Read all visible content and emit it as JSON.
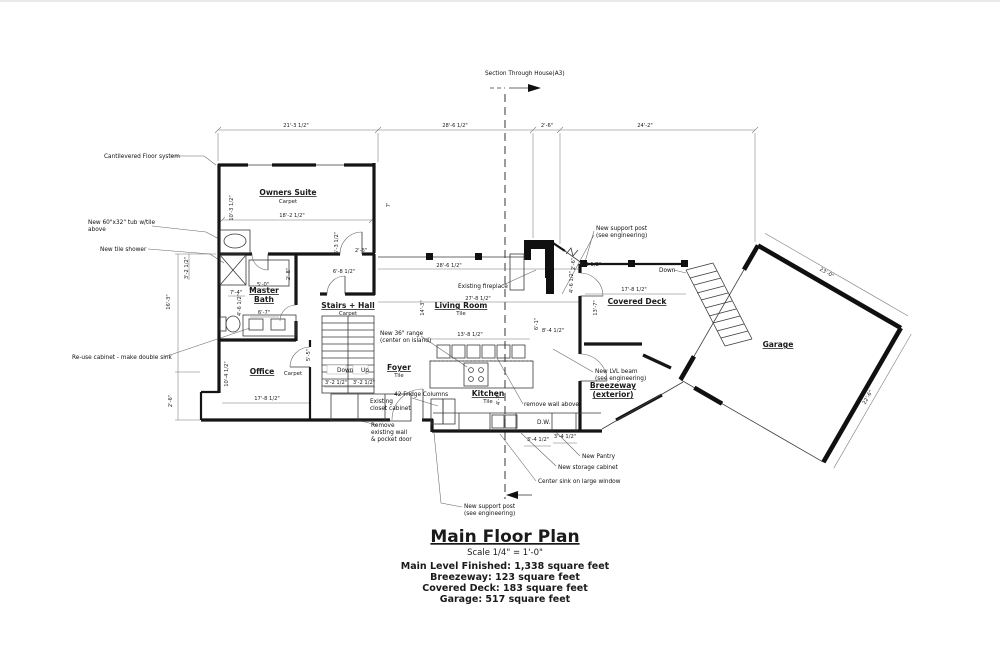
{
  "drawing": {
    "section_label": "Section Through House(A3)",
    "title": "Main Floor Plan",
    "scale": "Scale 1/4\" = 1'-0\"",
    "stats": [
      "Main Level Finished: 1,338 square feet",
      "Breezeway: 123 square feet",
      "Covered Deck: 183 square feet",
      "Garage: 517 square feet"
    ]
  },
  "rooms": [
    {
      "t": "Owners Suite",
      "x": 288,
      "y": 193
    },
    {
      "t": "Master",
      "x": 264,
      "y": 291
    },
    {
      "t": "Bath",
      "x": 264,
      "y": 300
    },
    {
      "t": "Office",
      "x": 262,
      "y": 372
    },
    {
      "t": "Stairs + Hall",
      "x": 348,
      "y": 306
    },
    {
      "t": "Foyer",
      "x": 399,
      "y": 368
    },
    {
      "t": "Living Room",
      "x": 461,
      "y": 306
    },
    {
      "t": "Kitchen",
      "x": 488,
      "y": 394
    },
    {
      "t": "Covered Deck",
      "x": 637,
      "y": 302
    },
    {
      "t": "Garage",
      "x": 778,
      "y": 345
    },
    {
      "t": "Breezeway",
      "x": 613,
      "y": 386
    },
    {
      "t": "(exterior)",
      "x": 613,
      "y": 395
    }
  ],
  "floor_finishes": [
    {
      "t": "Carpet",
      "x": 288,
      "y": 201
    },
    {
      "t": "Carpet",
      "x": 293,
      "y": 373
    },
    {
      "t": "Carpet",
      "x": 348,
      "y": 313
    },
    {
      "t": "Tile",
      "x": 399,
      "y": 375
    },
    {
      "t": "Tile",
      "x": 461,
      "y": 313
    },
    {
      "t": "Tile",
      "x": 488,
      "y": 401
    }
  ],
  "annotations": [
    {
      "t": "Section Through House(A3)",
      "x": 485,
      "y": 73
    },
    {
      "t": "Cantilevered Floor system",
      "x": 104,
      "y": 156
    },
    {
      "t": "New 60\"x32\" tub w/tile",
      "x": 88,
      "y": 222
    },
    {
      "t": "above",
      "x": 88,
      "y": 229
    },
    {
      "t": "New tile shower",
      "x": 100,
      "y": 249
    },
    {
      "t": "Re-use cabinet - make double sink",
      "x": 72,
      "y": 357
    },
    {
      "t": "Existing fireplace",
      "x": 458,
      "y": 286
    },
    {
      "t": "New support post",
      "x": 596,
      "y": 228
    },
    {
      "t": "(see engineering)",
      "x": 596,
      "y": 235
    },
    {
      "t": "Down",
      "x": 659,
      "y": 270
    },
    {
      "t": "New 36\" range",
      "x": 380,
      "y": 333
    },
    {
      "t": "(center on island)",
      "x": 380,
      "y": 340
    },
    {
      "t": "remove wall above",
      "x": 524,
      "y": 404
    },
    {
      "t": "New LVL beam",
      "x": 595,
      "y": 371
    },
    {
      "t": "(see engineering)",
      "x": 595,
      "y": 378
    },
    {
      "t": "New Pantry",
      "x": 582,
      "y": 456
    },
    {
      "t": "New storage cabinet",
      "x": 558,
      "y": 467
    },
    {
      "t": "Center sink on large window",
      "x": 538,
      "y": 481
    },
    {
      "t": "42 Fridge Columns",
      "x": 394,
      "y": 394
    },
    {
      "t": "Remove",
      "x": 371,
      "y": 425
    },
    {
      "t": "existing wall",
      "x": 371,
      "y": 432
    },
    {
      "t": "& pocket door",
      "x": 371,
      "y": 439
    },
    {
      "t": "New support post",
      "x": 464,
      "y": 506
    },
    {
      "t": "(see engineering)",
      "x": 464,
      "y": 513
    },
    {
      "t": "Existing",
      "x": 370,
      "y": 401,
      "a": "middle"
    },
    {
      "t": "closet cabinet",
      "x": 370,
      "y": 408,
      "a": "middle"
    },
    {
      "t": "Down",
      "x": 337,
      "y": 370,
      "a": "middle"
    },
    {
      "t": "Up",
      "x": 361,
      "y": 370,
      "a": "middle"
    },
    {
      "t": "D.W.",
      "x": 537,
      "y": 422,
      "a": "middle"
    }
  ],
  "dimensions": [
    {
      "t": "21'-3 1/2\"",
      "x": 296,
      "y": 125
    },
    {
      "t": "28'-6 1/2\"",
      "x": 455,
      "y": 125
    },
    {
      "t": "2'-6\"",
      "x": 547,
      "y": 125
    },
    {
      "t": "24'-2\"",
      "x": 645,
      "y": 125
    },
    {
      "t": "18'-2 1/2\"",
      "x": 292,
      "y": 215
    },
    {
      "t": "10'-3 1/2\"",
      "x": 233,
      "y": 206,
      "r": -90
    },
    {
      "t": "7'",
      "x": 390,
      "y": 203,
      "r": -90
    },
    {
      "t": "5'-3 1/2\"",
      "x": 338,
      "y": 241,
      "r": -90
    },
    {
      "t": "2'-6\"",
      "x": 361,
      "y": 250
    },
    {
      "t": "6'-8 1/2\"",
      "x": 344,
      "y": 271
    },
    {
      "t": "2'-8\"",
      "x": 290,
      "y": 272,
      "r": -90
    },
    {
      "t": "28'-6 1/2\"",
      "x": 449,
      "y": 265
    },
    {
      "t": "27'-8 1/2\"",
      "x": 478,
      "y": 298
    },
    {
      "t": "13'-8 1/2\"",
      "x": 470,
      "y": 334
    },
    {
      "t": "4'-3 1/2\"",
      "x": 590,
      "y": 264
    },
    {
      "t": "4'-6 1/2\"",
      "x": 573,
      "y": 280,
      "r": -90
    },
    {
      "t": "2'-6\"",
      "x": 575,
      "y": 262,
      "r": -90
    },
    {
      "t": "6'-1\"",
      "x": 538,
      "y": 322,
      "r": -90
    },
    {
      "t": "8'-4 1/2\"",
      "x": 553,
      "y": 330
    },
    {
      "t": "14'-3\"",
      "x": 424,
      "y": 306,
      "r": -90
    },
    {
      "t": "13'-7\"",
      "x": 597,
      "y": 306,
      "r": -90
    },
    {
      "t": "17'-8 1/2\"",
      "x": 634,
      "y": 289
    },
    {
      "t": "17'-8 1/2\"",
      "x": 267,
      "y": 398
    },
    {
      "t": "10'-4 1/2\"",
      "x": 228,
      "y": 372,
      "r": -90
    },
    {
      "t": "5'-5\"",
      "x": 310,
      "y": 353,
      "r": -90
    },
    {
      "t": "3'-2 1/2\"",
      "x": 336,
      "y": 382
    },
    {
      "t": "3'-2 1/2\"",
      "x": 364,
      "y": 382
    },
    {
      "t": "5'-0\"",
      "x": 263,
      "y": 284
    },
    {
      "t": "7'-4\"",
      "x": 236,
      "y": 292
    },
    {
      "t": "4'-6 1/2\"",
      "x": 241,
      "y": 303,
      "r": -90
    },
    {
      "t": "6'-7\"",
      "x": 264,
      "y": 312
    },
    {
      "t": "3'-2 1/2\"",
      "x": 188,
      "y": 266,
      "r": -90
    },
    {
      "t": "16'-3\"",
      "x": 170,
      "y": 300,
      "r": -90
    },
    {
      "t": "2'-6\"",
      "x": 172,
      "y": 399,
      "r": -90
    },
    {
      "t": "4'-7\"",
      "x": 500,
      "y": 397,
      "r": -90
    },
    {
      "t": "3'-4 1/2\"",
      "x": 538,
      "y": 439
    },
    {
      "t": "3'-4 1/2\"",
      "x": 565,
      "y": 436
    },
    {
      "t": "23'-0\"",
      "x": 826,
      "y": 272,
      "r": 30
    },
    {
      "t": "22'-6\"",
      "x": 869,
      "y": 396,
      "r": -60
    }
  ]
}
